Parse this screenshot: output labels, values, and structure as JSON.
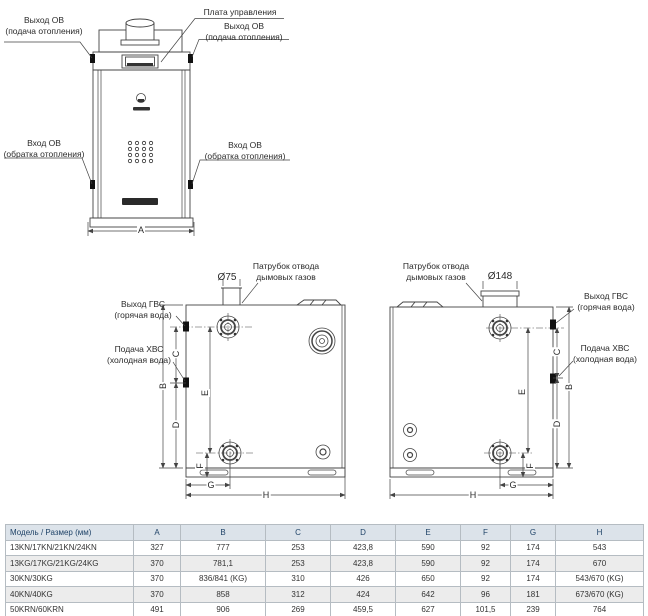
{
  "front_view": {
    "label_outlet_left": "Выход ОВ\n(подача отопления)",
    "label_control_board": "Плата управления",
    "label_outlet_right": "Выход ОВ\n(подача отопления)",
    "label_inlet_left": "Вход ОВ\n(обратка отопления)",
    "label_inlet_right": "Вход ОВ\n(обратка отопления)"
  },
  "side_view_small": {
    "flue_diameter": "Ø75",
    "label_flue": "Патрубок отвода\nдымовых газов",
    "label_dhw_out": "Выход ГВС\n(горячая вода)",
    "label_cw_in": "Подача ХВС\n(холодная вода)"
  },
  "side_view_large": {
    "flue_diameter": "Ø148",
    "label_flue": "Патрубок отвода\nдымовых газов",
    "label_dhw_out": "Выход ГВС\n(горячая вода)",
    "label_cw_in": "Подача ХВС\n(холодная вода)"
  },
  "dims": {
    "a": "A",
    "b": "B",
    "c": "C",
    "d": "D",
    "e": "E",
    "f": "F",
    "g": "G",
    "h": "H"
  },
  "table": {
    "header_model": "Модель / Размер (мм)",
    "header_dims": [
      "A",
      "B",
      "C",
      "D",
      "E",
      "F",
      "G",
      "H"
    ],
    "rows": [
      {
        "model": "13KN/17KN/21KN/24KN",
        "values": [
          "327",
          "777",
          "253",
          "423,8",
          "590",
          "92",
          "174",
          "543"
        ]
      },
      {
        "model": "13KG/17KG/21KG/24KG",
        "values": [
          "370",
          "781,1",
          "253",
          "423,8",
          "590",
          "92",
          "174",
          "670"
        ]
      },
      {
        "model": "30KN/30KG",
        "values": [
          "370",
          "836/841 (KG)",
          "310",
          "426",
          "650",
          "92",
          "174",
          "543/670 (KG)"
        ]
      },
      {
        "model": "40KN/40KG",
        "values": [
          "370",
          "858",
          "312",
          "424",
          "642",
          "96",
          "181",
          "673/670 (KG)"
        ]
      },
      {
        "model": "50KRN/60KRN",
        "values": [
          "491",
          "906",
          "269",
          "459,5",
          "627",
          "101,5",
          "239",
          "764"
        ]
      }
    ]
  },
  "colors": {
    "line": "#444444",
    "table_header_bg": "#dce3ea",
    "table_header_text": "#1f4368",
    "table_border": "#b5bcc2",
    "row_alt": "#ececec"
  }
}
